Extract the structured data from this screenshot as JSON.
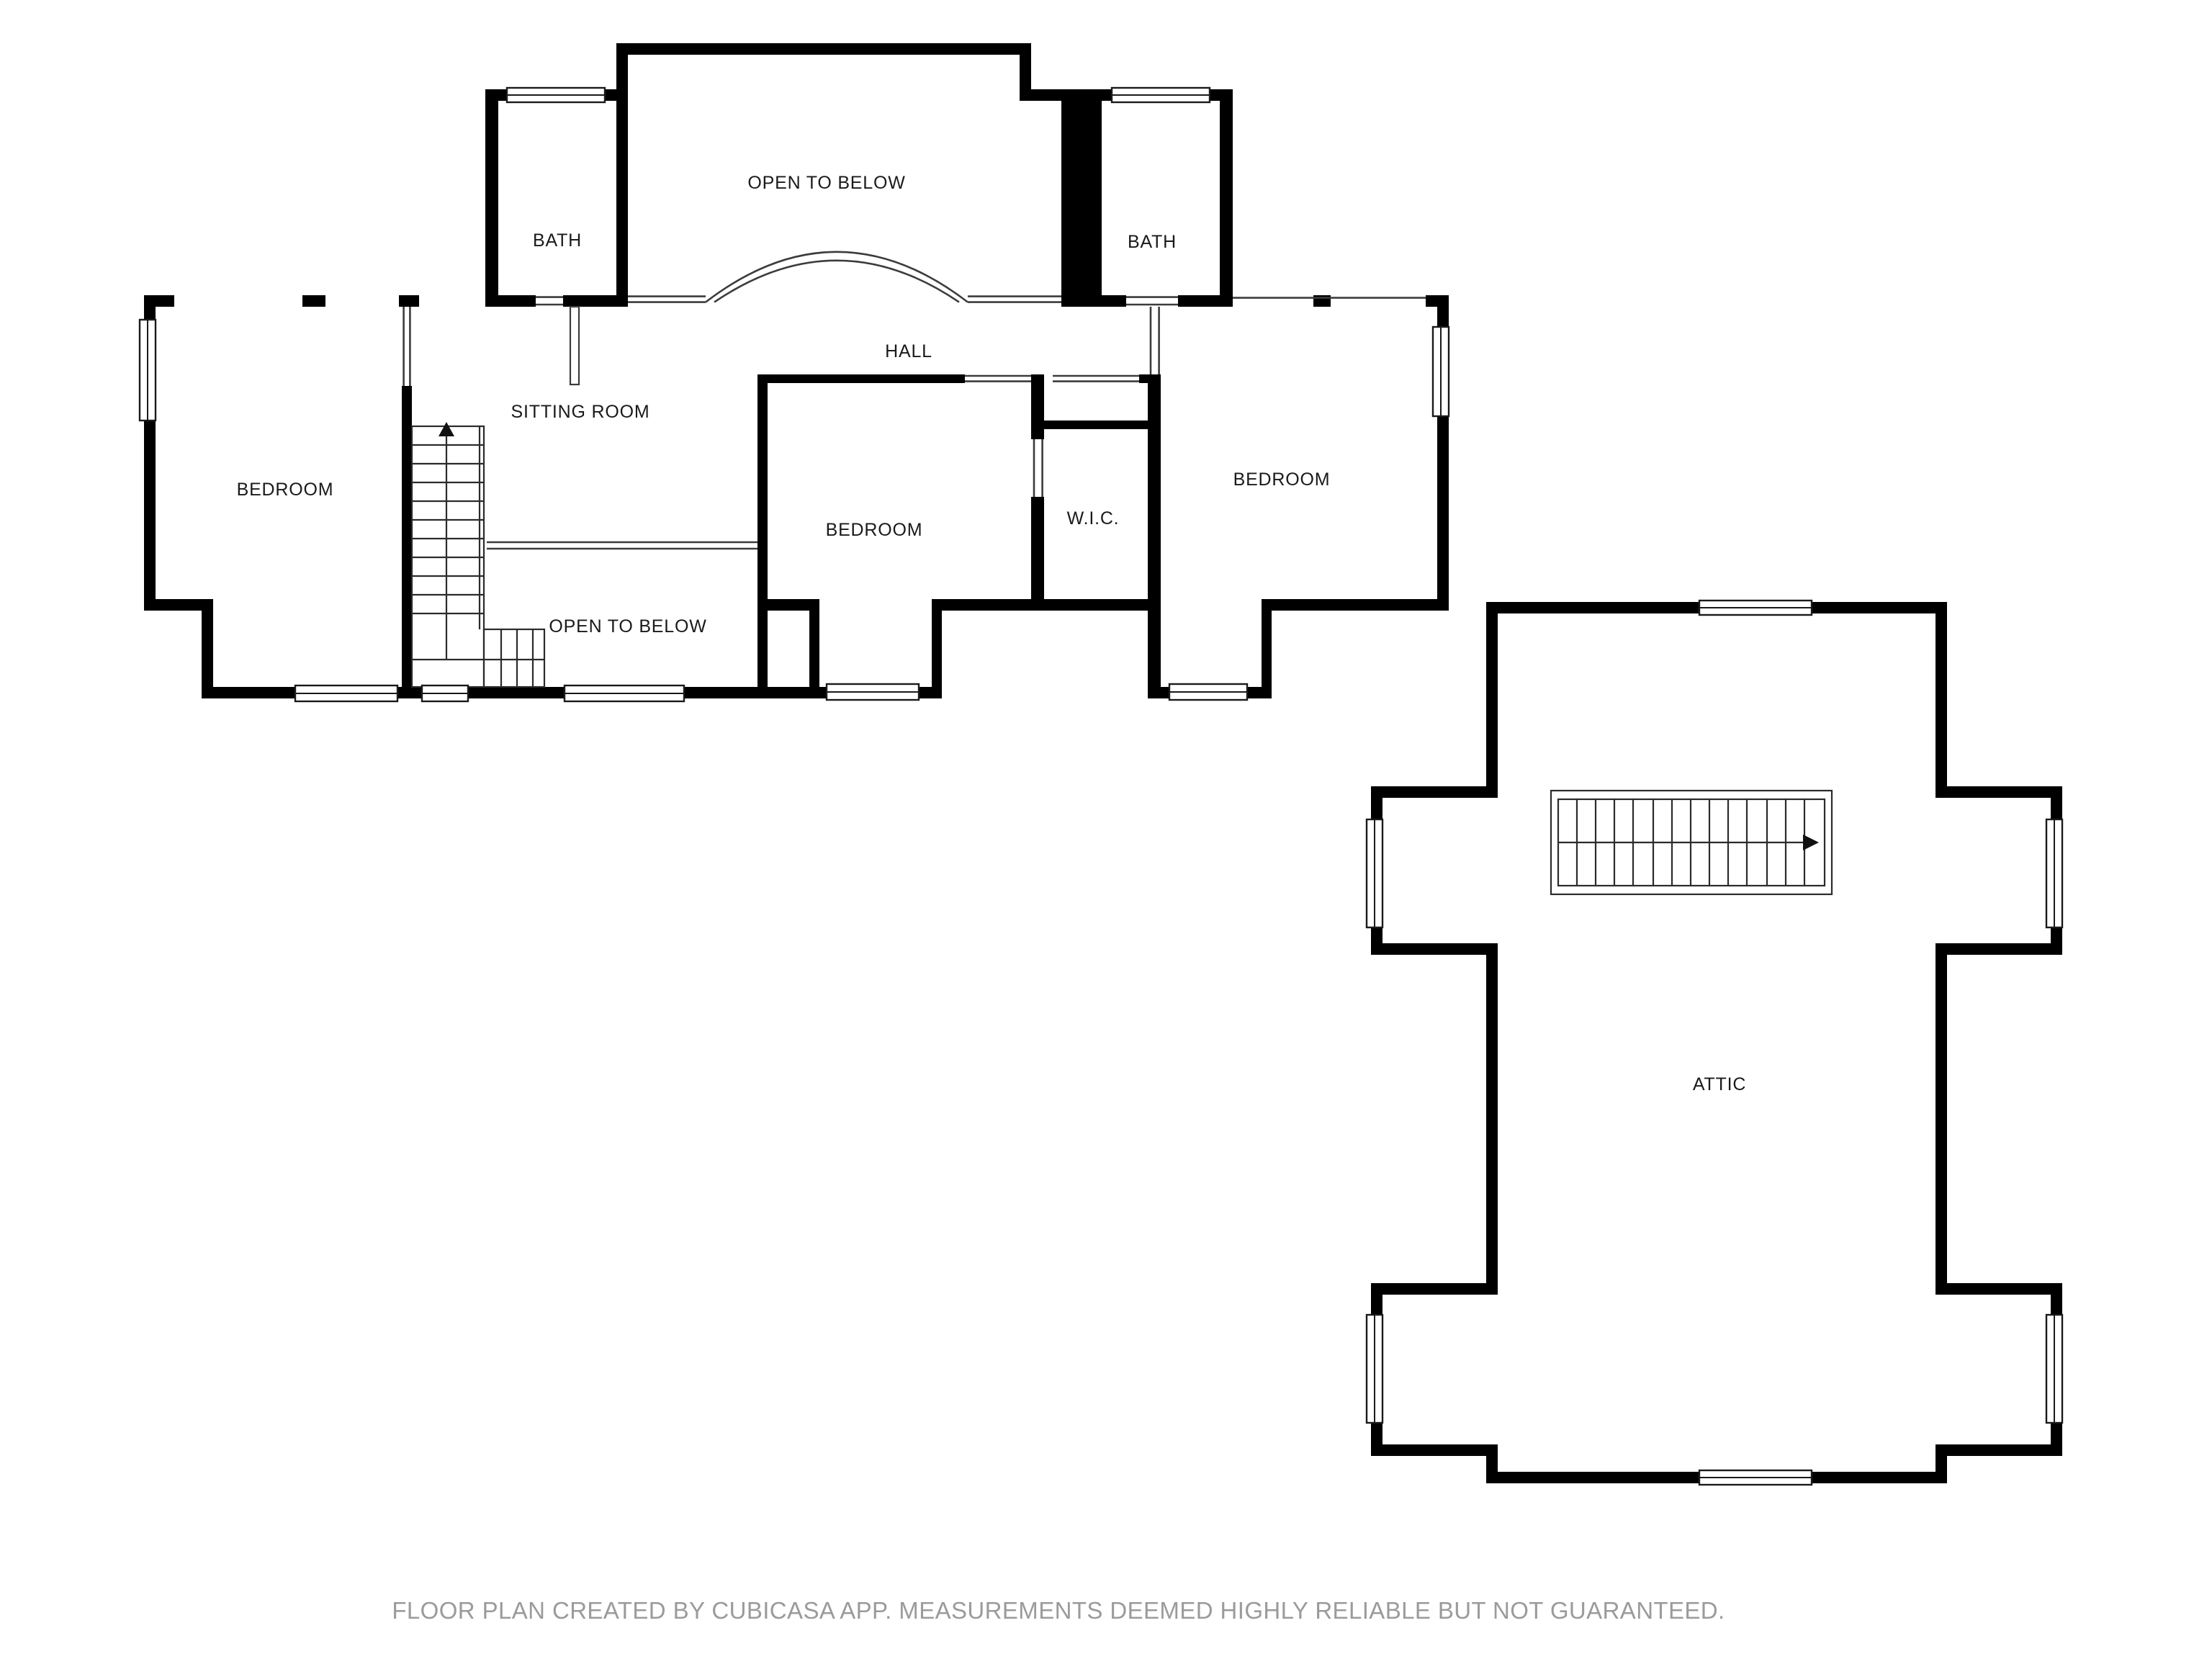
{
  "page": {
    "background": "#ffffff"
  },
  "floor_plan": {
    "labels": {
      "bath_left": "BATH",
      "open_to_below_top": "OPEN TO BELOW",
      "bath_right": "BATH",
      "hall": "HALL",
      "sitting_room": "SITTING ROOM",
      "bedroom_left": "BEDROOM",
      "open_to_below_small": "OPEN TO BELOW",
      "bedroom_middle": "BEDROOM",
      "wic": "W.I.C.",
      "bedroom_right": "BEDROOM",
      "attic": "ATTIC"
    },
    "icons": {
      "main_stair_direction": "arrow-up",
      "attic_stair_direction": "arrow-right"
    },
    "colors": {
      "walls": "#000000",
      "thin_lines": "#3c3c3c",
      "labels": "#1a1a1a",
      "footer_text": "#9b9b9b",
      "background": "#ffffff"
    }
  },
  "footer": {
    "disclaimer": "FLOOR PLAN CREATED BY CUBICASA APP. MEASUREMENTS DEEMED HIGHLY RELIABLE BUT NOT GUARANTEED."
  }
}
